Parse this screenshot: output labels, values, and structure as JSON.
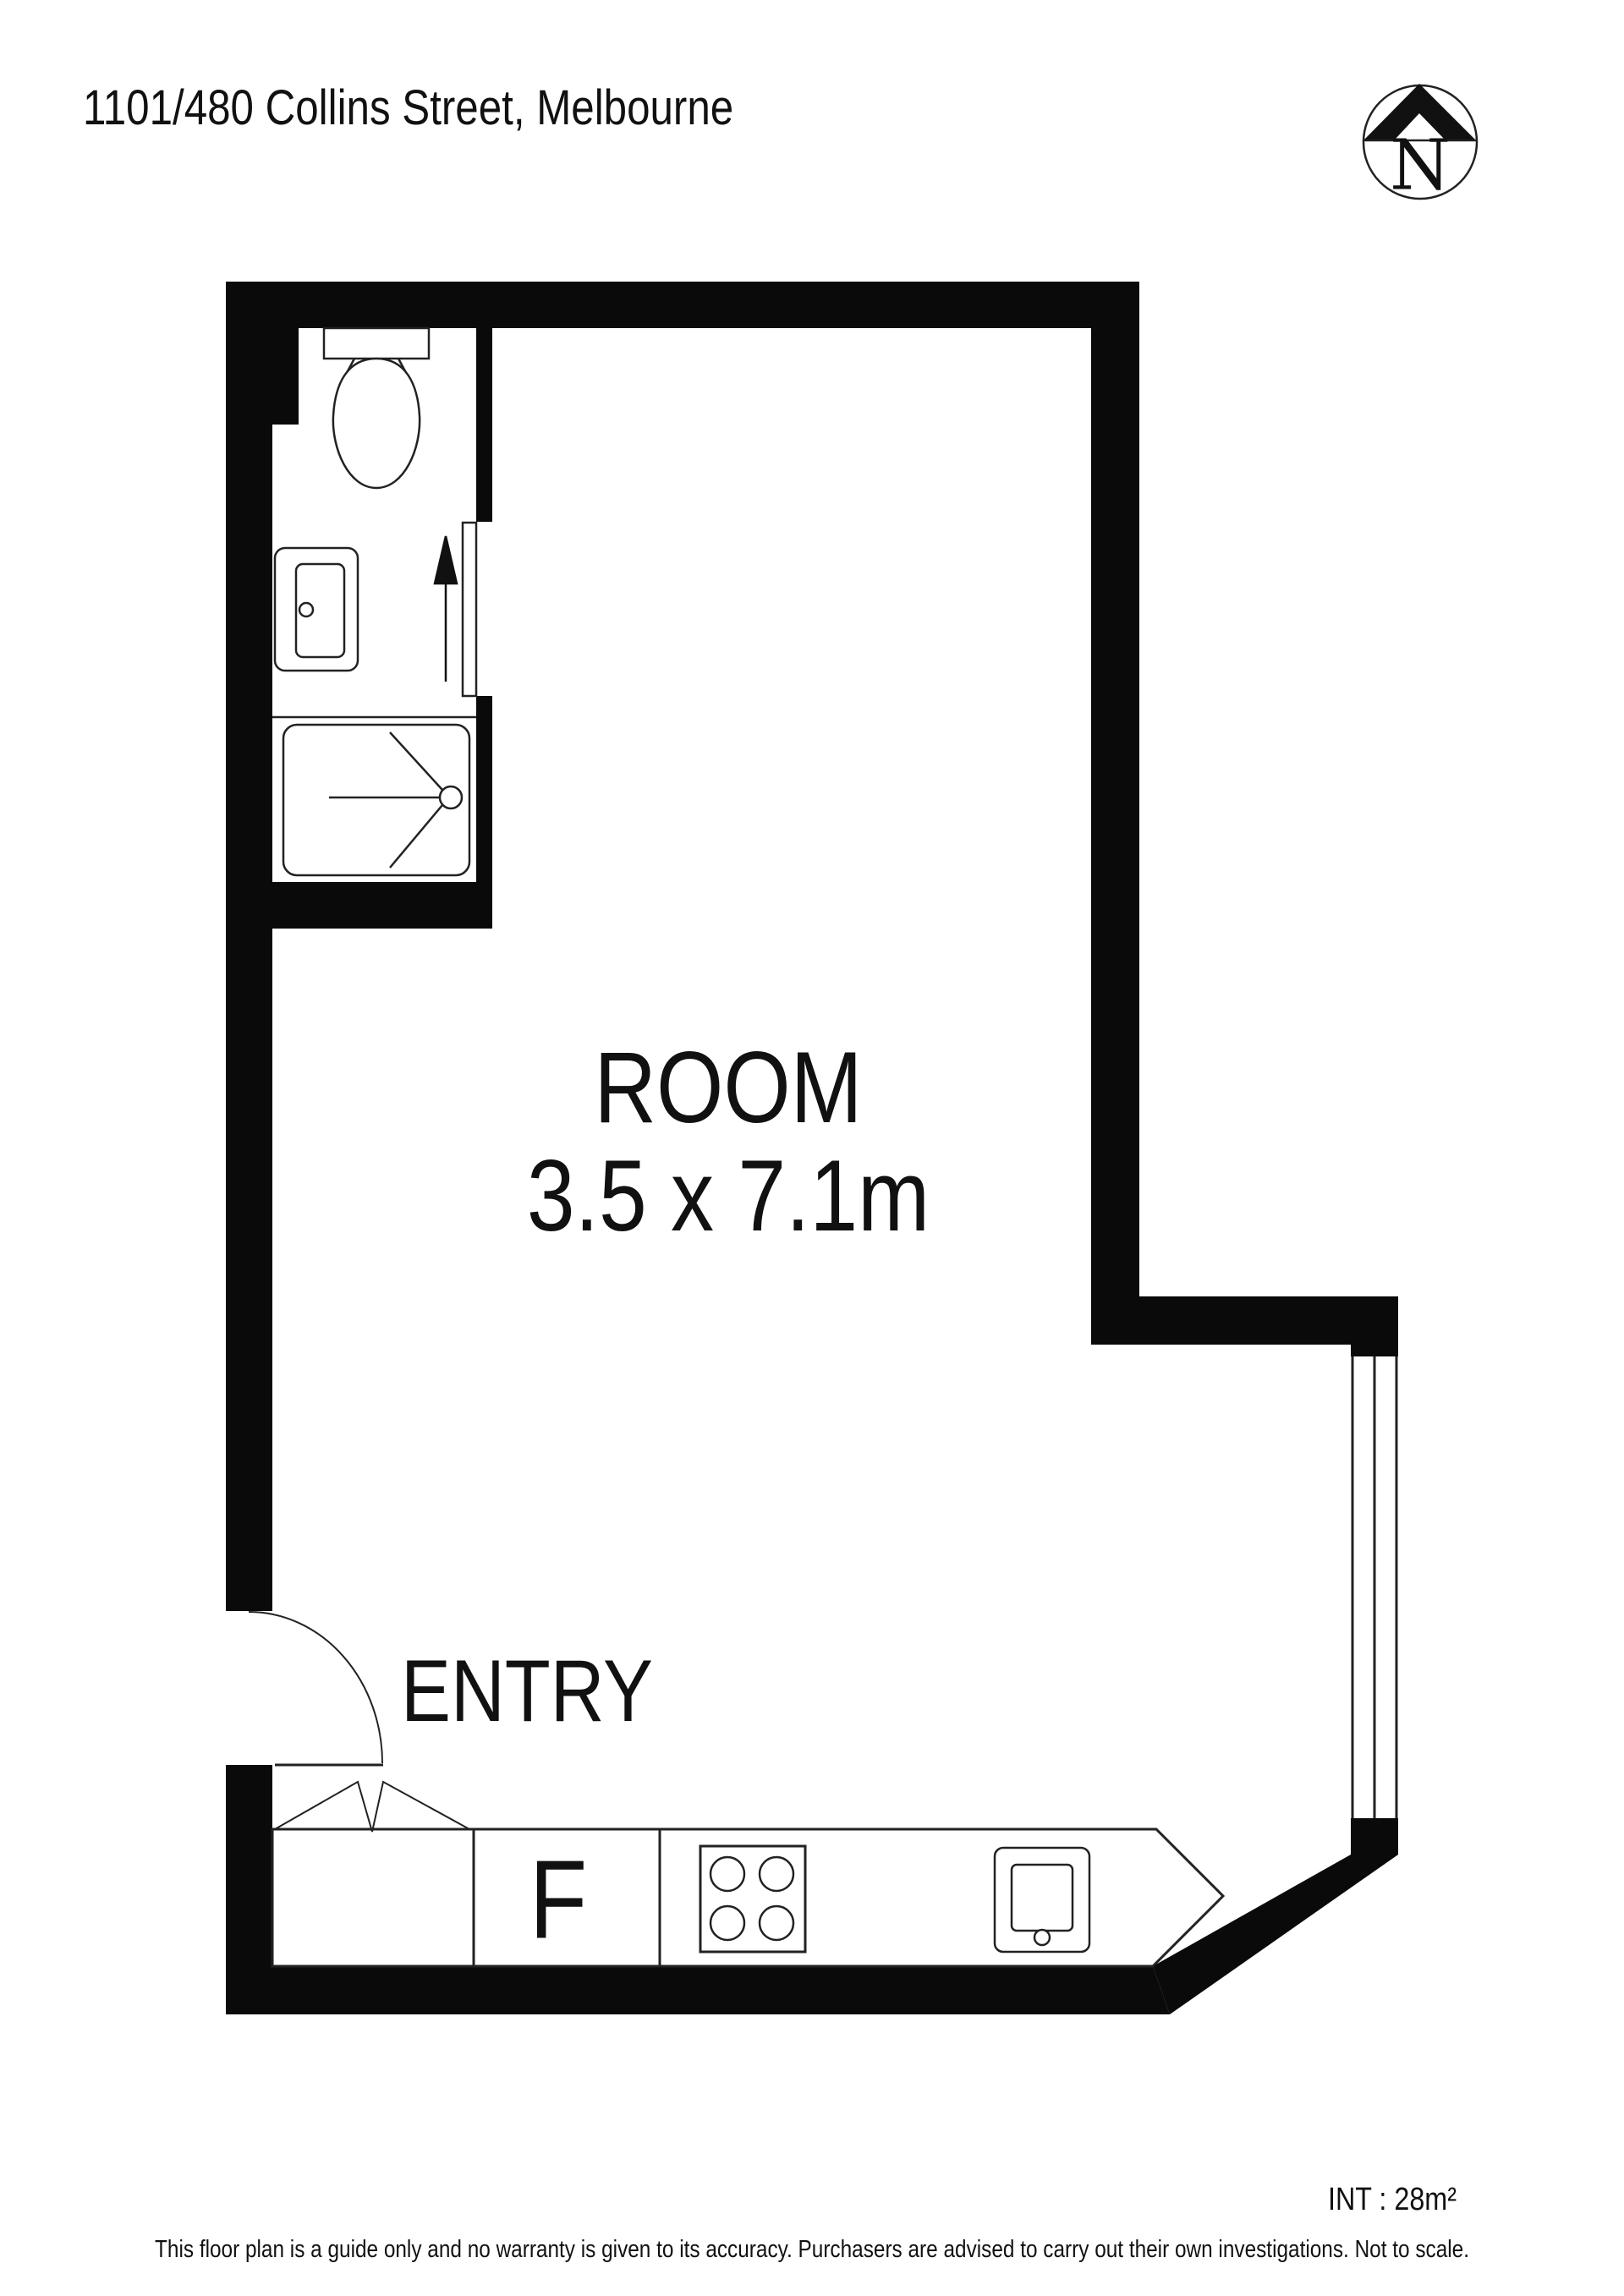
{
  "title": "1101/480 Collins Street, Melbourne",
  "compass": {
    "label": "N"
  },
  "plan": {
    "room": {
      "name": "ROOM",
      "dimensions": "3.5 x 7.1m"
    },
    "entry": {
      "label": "ENTRY"
    },
    "kitchen": {
      "fridge_label": "F"
    },
    "fixtures": [
      "toilet",
      "vanity-sink",
      "shower",
      "sliding-door",
      "cooktop",
      "kitchen-sink",
      "entry-door",
      "window"
    ]
  },
  "footer": {
    "area": "INT : 28m²",
    "disclaimer": "This floor plan is a guide only and no warranty is given to its accuracy. Purchasers are advised to carry out their own investigations. Not to scale."
  },
  "colors": {
    "walls": "#0a0a0a",
    "lines": "#222222",
    "background": "#ffffff"
  }
}
